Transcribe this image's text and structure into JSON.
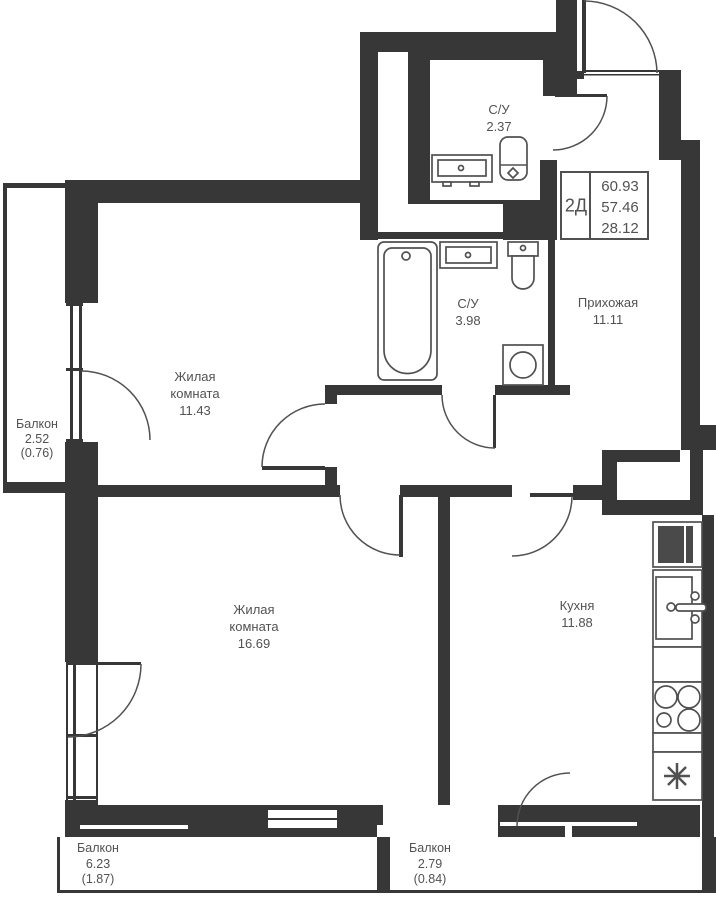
{
  "info_box": {
    "type": "2Д",
    "values": [
      "60.93",
      "57.46",
      "28.12"
    ]
  },
  "rooms": {
    "bath_small": {
      "name": "С/У",
      "area": "2.37"
    },
    "bath_big": {
      "name": "С/У",
      "area": "3.98"
    },
    "hallway": {
      "name": "Прихожая",
      "area": "11.11"
    },
    "living1": {
      "name_line1": "Жилая",
      "name_line2": "комната",
      "area": "11.43"
    },
    "living2": {
      "name_line1": "Жилая",
      "name_line2": "комната",
      "area": "16.69"
    },
    "kitchen": {
      "name": "Кухня",
      "area": "11.88"
    },
    "balcony_left": {
      "name": "Балкон",
      "area": "2.52",
      "area_reduced": "(0.76)"
    },
    "balcony_bottom_left": {
      "name": "Балкон",
      "area": "6.23",
      "area_reduced": "(1.87)"
    },
    "balcony_bottom_right": {
      "name": "Балкон",
      "area": "2.79",
      "area_reduced": "(0.84)"
    }
  },
  "colors": {
    "wall": "#373737",
    "line": "#515151",
    "text": "#525252",
    "bg": "#ffffff"
  }
}
